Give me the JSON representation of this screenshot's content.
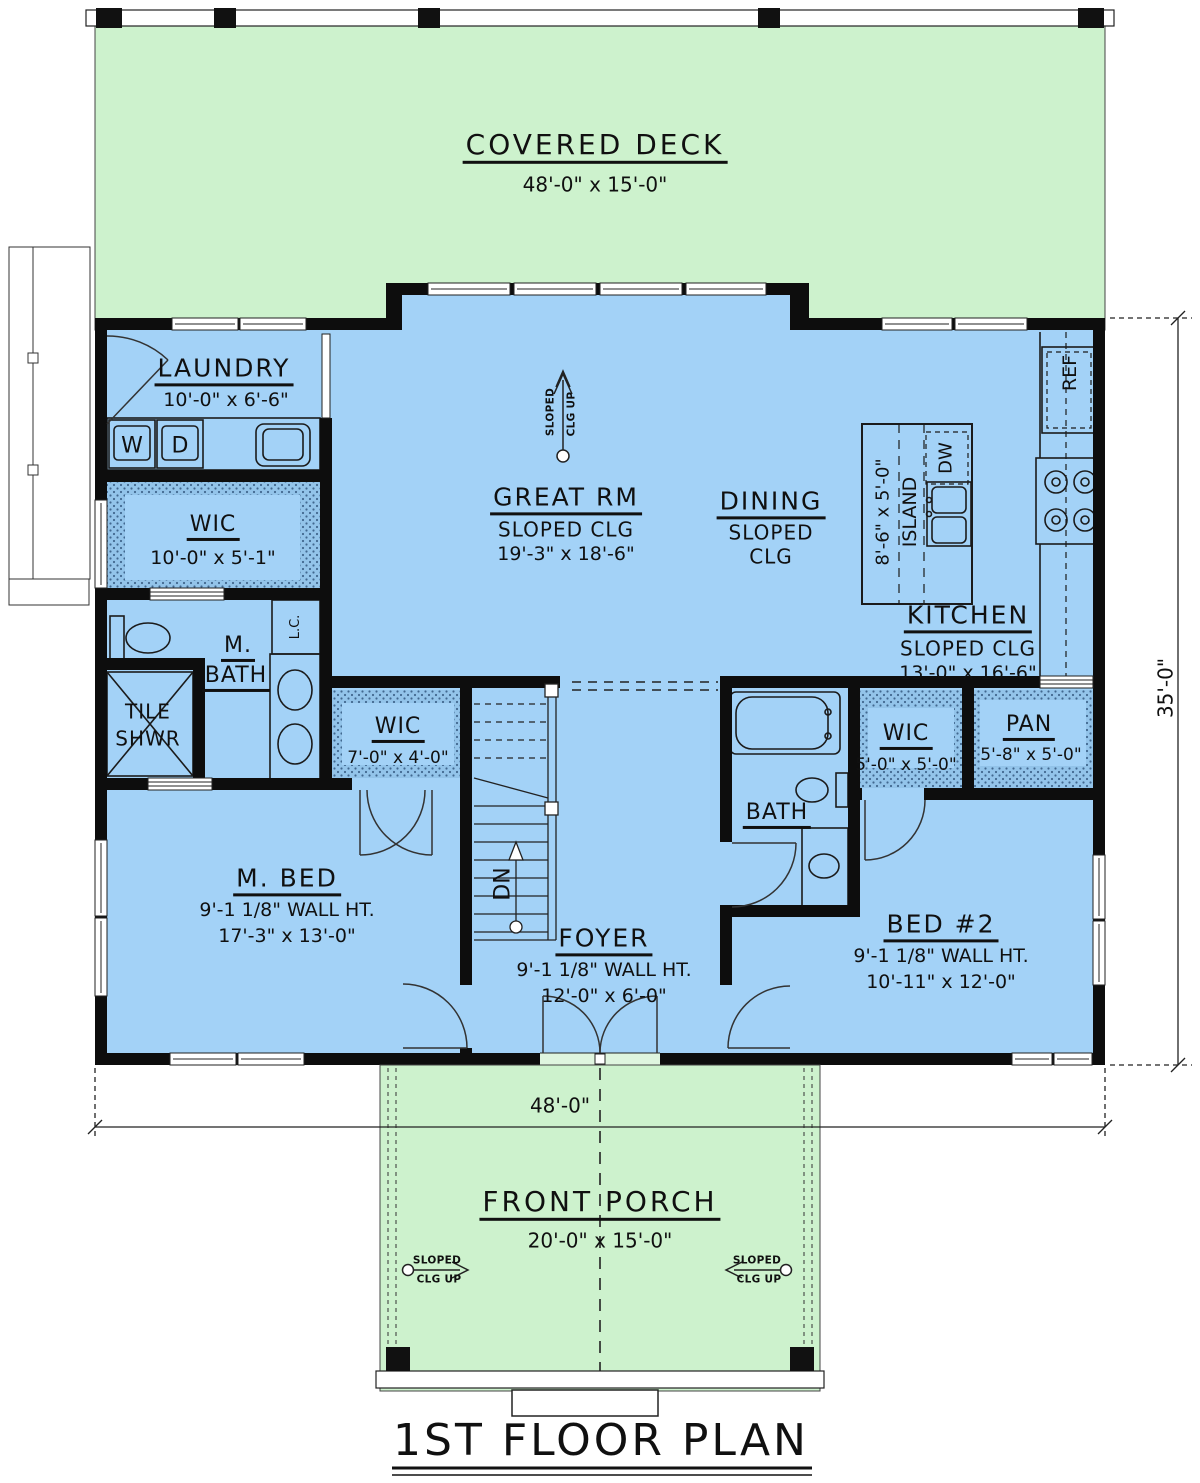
{
  "plan_title": "1ST FLOOR PLAN",
  "dimensions": {
    "overall_width": "48'-0\"",
    "overall_depth": "35'-0\""
  },
  "deck": {
    "name": "COVERED DECK",
    "dims": "48'-0\" x 15'-0\""
  },
  "porch": {
    "name": "FRONT PORCH",
    "dims": "20'-0\" x 15'-0\""
  },
  "rooms": {
    "laundry": {
      "name": "LAUNDRY",
      "dims": "10'-0\" x 6'-6\""
    },
    "great_rm": {
      "name": "GREAT RM",
      "ceiling": "SLOPED CLG",
      "dims": "19'-3\" x 18'-6\""
    },
    "dining": {
      "name": "DINING",
      "ceiling_line1": "SLOPED",
      "ceiling_line2": "CLG"
    },
    "kitchen": {
      "name": "KITCHEN",
      "ceiling": "SLOPED CLG",
      "dims": "13'-0\" x 16'-6\""
    },
    "wic_master": {
      "name": "WIC",
      "dims": "10'-0\" x 5'-1\""
    },
    "m_bath": {
      "name_line1": "M.",
      "name_line2": "BATH"
    },
    "tile_shwr": {
      "name_line1": "TILE",
      "name_line2": "SHWR"
    },
    "wic_mbed": {
      "name": "WIC",
      "dims": "7'-0\" x 4'-0\""
    },
    "m_bed": {
      "name": "M. BED",
      "wall_ht": "9'-1 1/8\" WALL HT.",
      "dims": "17'-3\" x 13'-0\""
    },
    "foyer": {
      "name": "FOYER",
      "wall_ht": "9'-1 1/8\" WALL HT.",
      "dims": "12'-0\" x 6'-0\""
    },
    "bath2": {
      "name": "BATH"
    },
    "wic_bed2": {
      "name": "WIC",
      "dims": "5'-0\" x 5'-0\""
    },
    "pantry": {
      "name": "PAN",
      "dims": "5'-8\" x 5'-0\""
    },
    "bed2": {
      "name": "BED #2",
      "wall_ht": "9'-1 1/8\" WALL HT.",
      "dims": "10'-11\" x 12'-0\""
    }
  },
  "fixtures": {
    "washer": "W",
    "dryer": "D",
    "dishwasher": "DW",
    "refrigerator": "REF",
    "linen_closet": "L.C.",
    "island": "ISLAND",
    "island_dims": "8'-6\" x 5'-0\"",
    "stairs_down": "DN"
  },
  "annotations": {
    "sloped_line1": "SLOPED",
    "sloped_line2": "CLG UP"
  },
  "colors": {
    "deck_green": "#cdf2cd",
    "interior_blue": "#a3d2f7",
    "hatch_blue": "#93c4ea",
    "wall_black": "#0d0d0d"
  }
}
